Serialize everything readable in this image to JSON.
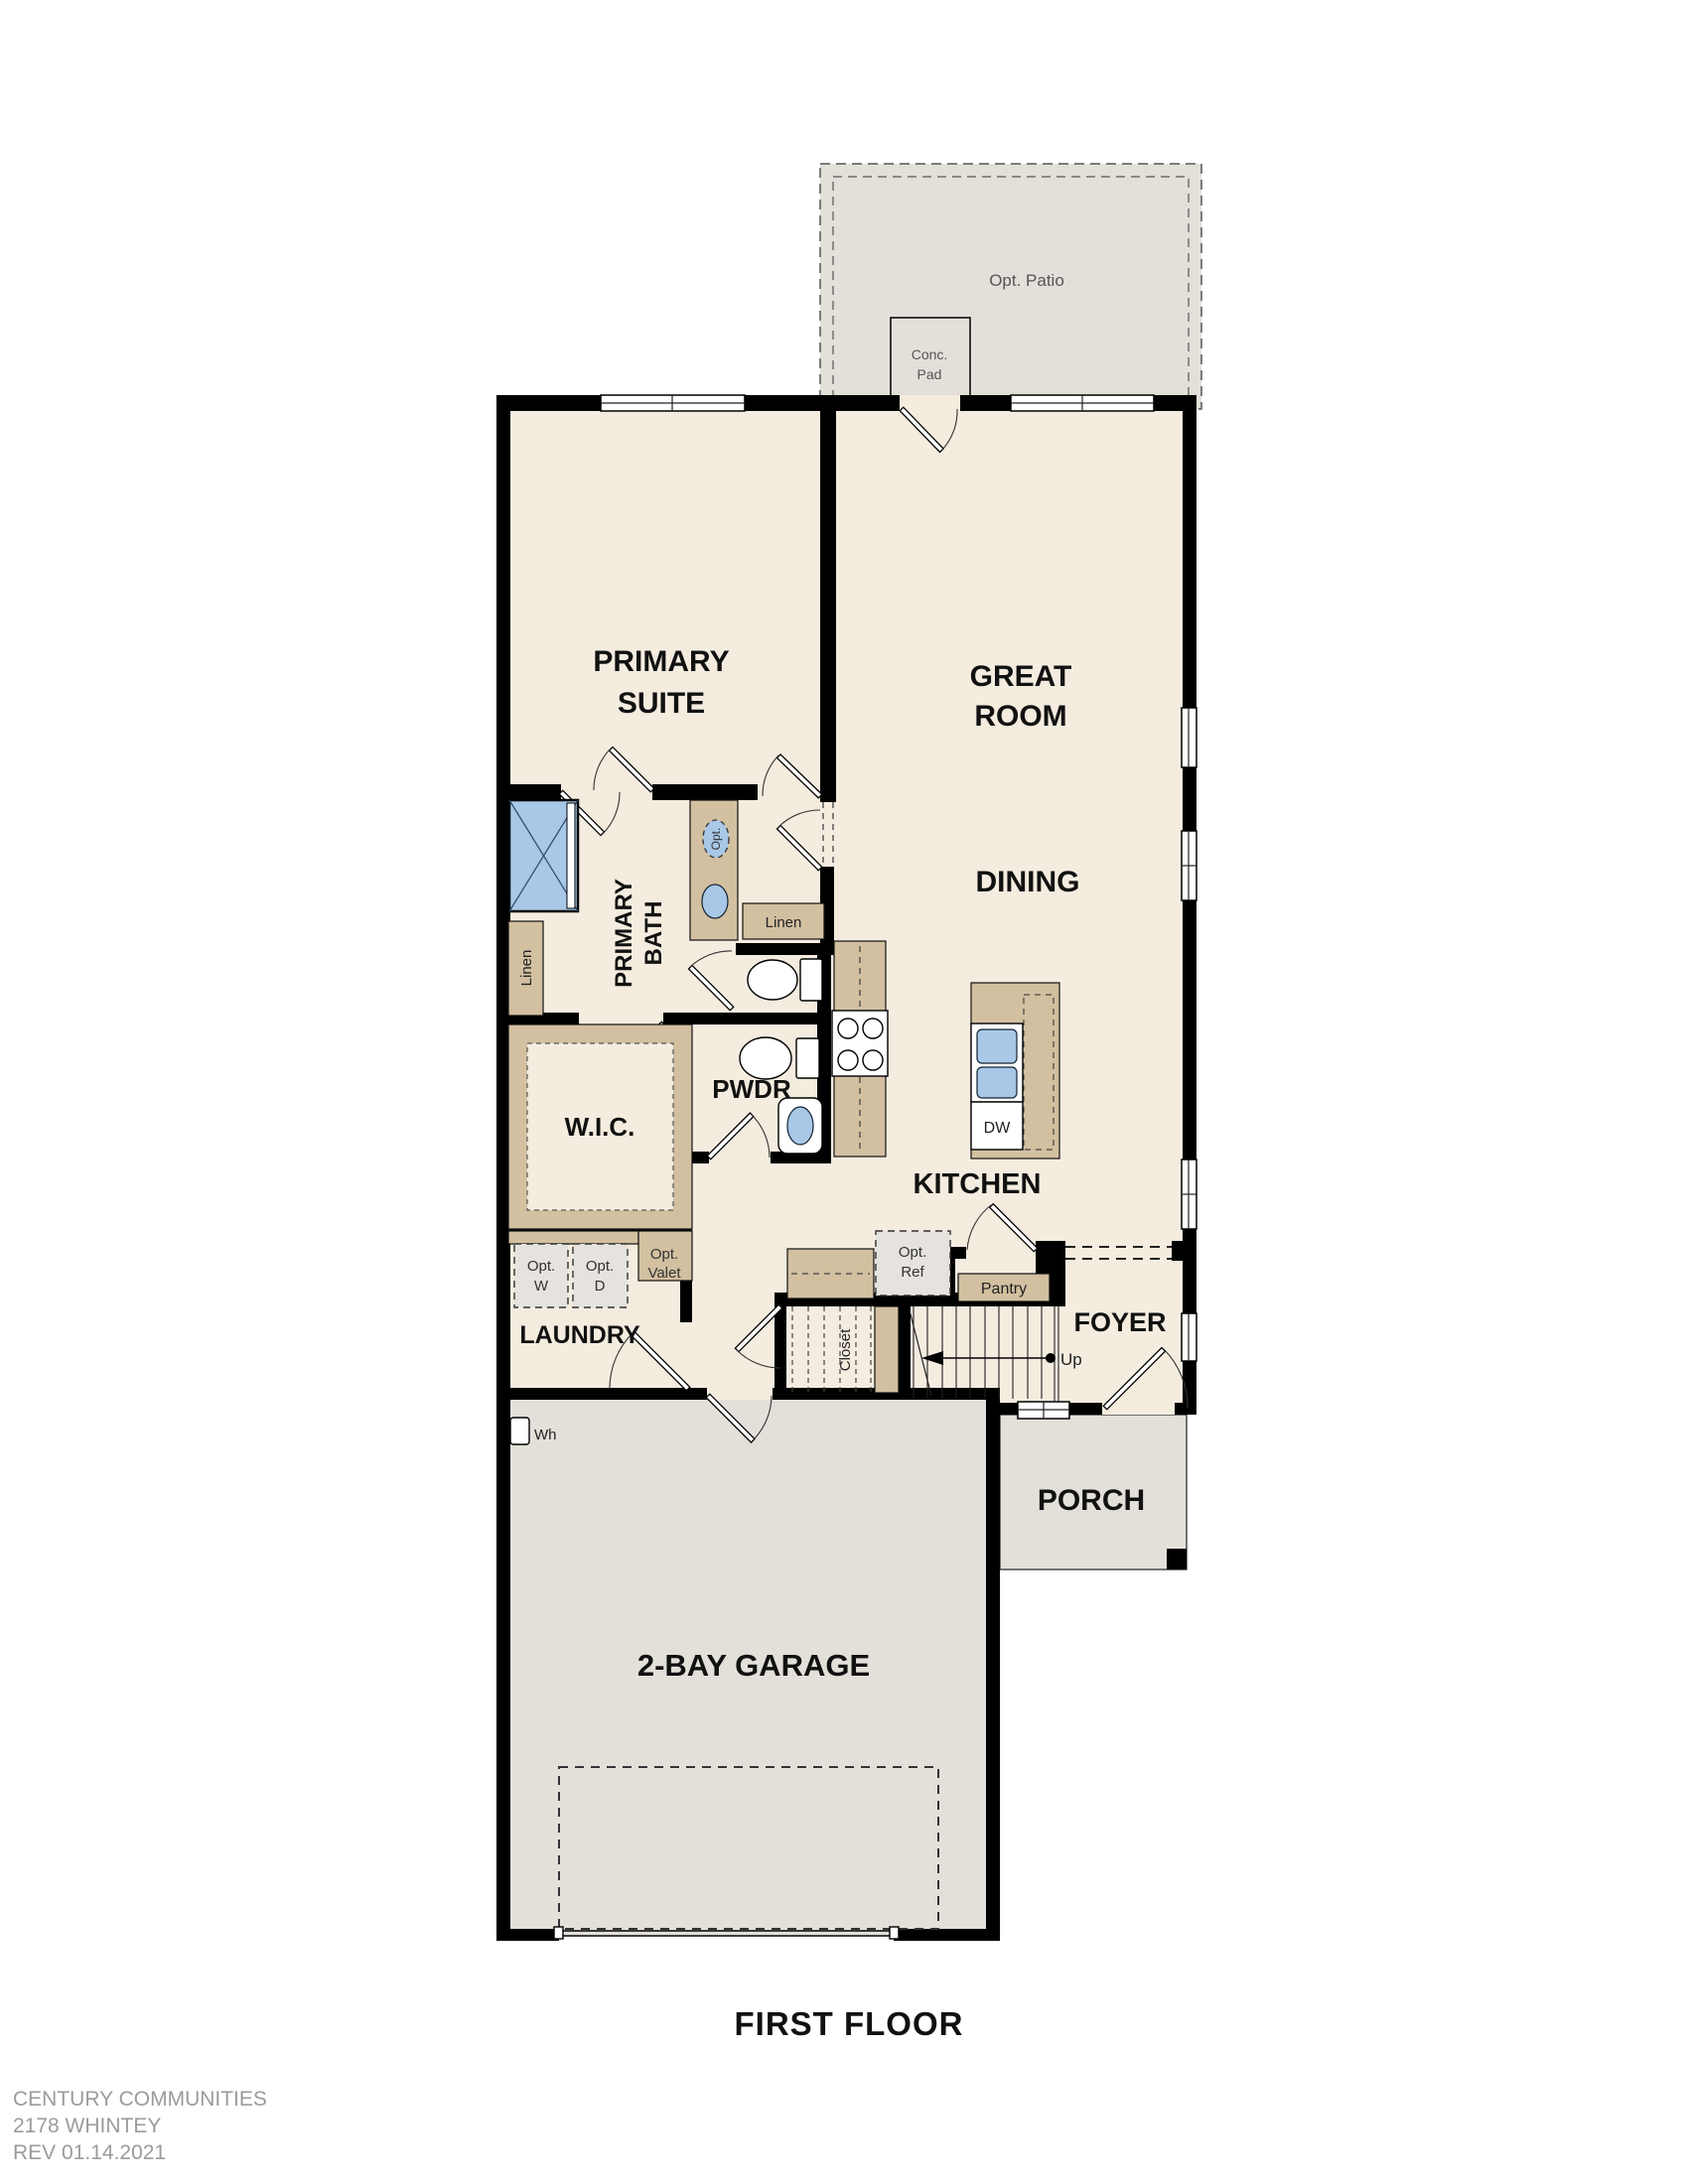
{
  "page_title": "FIRST FLOOR",
  "colors": {
    "wall": "#000000",
    "floor_interior": "#f4ecdf",
    "floor_concrete": "#e3e0da",
    "cabinet_tan": "#d2c0a0",
    "fixture_blue": "#a9c8e8",
    "optional_fill": "#e6e3de",
    "brand_gray": "#9b9b9b"
  },
  "rooms": {
    "primary_suite": {
      "label_line1": "PRIMARY",
      "label_line2": "SUITE"
    },
    "great_room": {
      "label_line1": "GREAT",
      "label_line2": "ROOM"
    },
    "dining": {
      "label": "DINING"
    },
    "kitchen": {
      "label": "KITCHEN"
    },
    "primary_bath": {
      "label_line1": "PRIMARY",
      "label_line2": "BATH"
    },
    "wic": {
      "label": "W.I.C."
    },
    "powder": {
      "label": "PWDR"
    },
    "laundry": {
      "label": "LAUNDRY"
    },
    "foyer": {
      "label": "FOYER"
    },
    "porch": {
      "label": "PORCH"
    },
    "garage": {
      "label": "2-BAY GARAGE"
    }
  },
  "annotations": {
    "opt_patio": "Opt. Patio",
    "conc_pad": {
      "line1": "Conc.",
      "line2": "Pad"
    },
    "linen_bath": "Linen",
    "linen_hall": "Linen",
    "opt_sink": "Opt.",
    "closet": "Closet",
    "pantry": "Pantry",
    "opt_ref": {
      "line1": "Opt.",
      "line2": "Ref"
    },
    "opt_washer": {
      "line1": "Opt.",
      "line2": "W"
    },
    "opt_dryer": {
      "line1": "Opt.",
      "line2": "D"
    },
    "opt_valet": {
      "line1": "Opt.",
      "line2": "Valet"
    },
    "dishwasher": "DW",
    "water_heater": "Wh",
    "stair_direction": "Up"
  },
  "footer": {
    "company": "CENTURY COMMUNITIES",
    "plan": "2178 WHINTEY",
    "revision": "REV 01.14.2021"
  }
}
